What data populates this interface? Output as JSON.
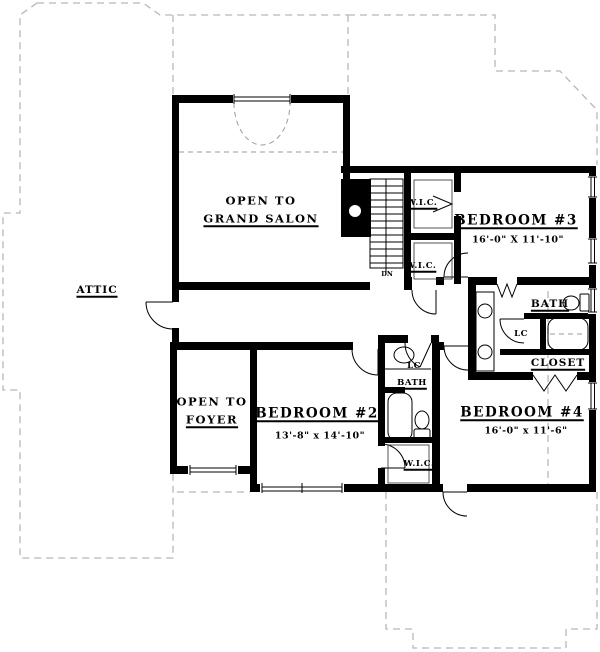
{
  "floor_plan": {
    "labels": {
      "grand_salon": {
        "prefix": "OPEN TO",
        "name": "GRAND SALON"
      },
      "foyer": {
        "prefix": "OPEN TO",
        "name": "FOYER"
      },
      "attic": {
        "name": "ATTIC"
      },
      "bedroom_2": {
        "name": "BEDROOM #2",
        "dims": "13'-8\" x 14'-10\""
      },
      "bedroom_3": {
        "name": "BEDROOM #3",
        "dims": "16'-0\" X 11'-10\""
      },
      "bedroom_4": {
        "name": "BEDROOM #4",
        "dims": "16'-0\" x 11'-6\""
      },
      "wic_upper": {
        "name": "W.I.C."
      },
      "wic_lower": {
        "name": "W.I.C."
      },
      "wic_bedroom_2": {
        "name": "W.I.C."
      },
      "bath_hall": {
        "name": "BATH"
      },
      "bath_shared": {
        "name": "BATH"
      },
      "linen_hall": {
        "name": "LC"
      },
      "linen_shared": {
        "name": "LC"
      },
      "closet": {
        "name": "CLOSET"
      },
      "stairs": {
        "direction": "DN"
      }
    },
    "colors": {
      "wall": "#000000",
      "dashed_outline": "#b8b8b8",
      "background": "#ffffff",
      "text": "#000000"
    }
  }
}
